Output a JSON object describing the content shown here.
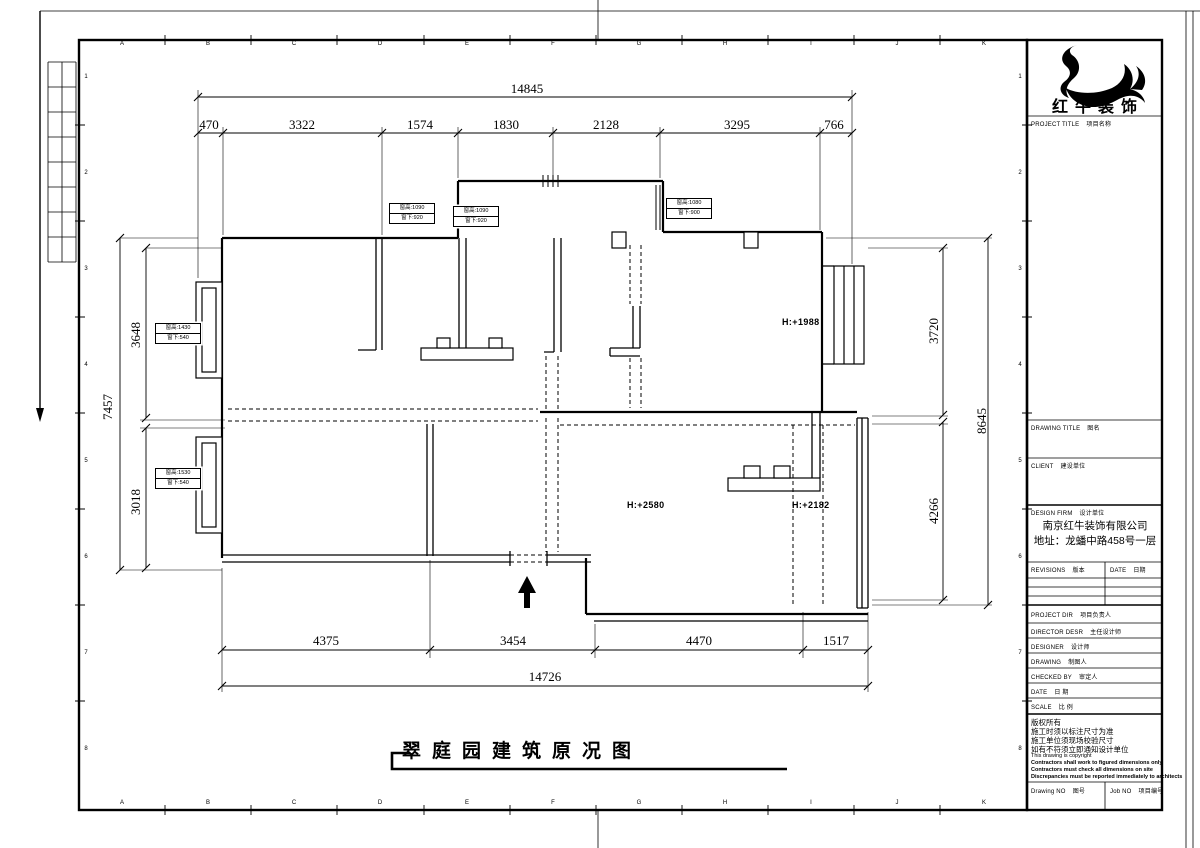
{
  "sheet": {
    "title": "翠庭园建筑原况图",
    "grid_letters": [
      "A",
      "B",
      "C",
      "D",
      "E",
      "F",
      "G",
      "H",
      "I",
      "J",
      "K"
    ],
    "grid_numbers": [
      "1",
      "2",
      "3",
      "4",
      "5",
      "6",
      "7",
      "8"
    ]
  },
  "dims": {
    "top_total": "14845",
    "top_segments": [
      "470",
      "3322",
      "1574",
      "1830",
      "2128",
      "3295",
      "766"
    ],
    "bottom_segments": [
      "4375",
      "3454",
      "4470",
      "1517"
    ],
    "bottom_total": "14726",
    "left_total": "7457",
    "left_upper": "3648",
    "left_lower": "3018",
    "right_upper": "3720",
    "right_lower": "4266",
    "right_total": "8645"
  },
  "plan_labels": {
    "room_right_height": "H:+1988",
    "living_height": "H:+2580",
    "balcony_height": "H:+2182",
    "window_tags": [
      {
        "l1": "窗高:1090",
        "l2": "窗下:920"
      },
      {
        "l1": "窗高:1090",
        "l2": "窗下:920"
      },
      {
        "l1": "窗高:1080",
        "l2": "窗下:900"
      },
      {
        "l1": "窗高:1430",
        "l2": "窗下:540"
      },
      {
        "l1": "窗高:1530",
        "l2": "窗下:540"
      }
    ]
  },
  "titleblock": {
    "brand": "红牛装饰",
    "project_title_en": "PROJECT TITLE",
    "project_title_cn": "项目名称",
    "drawing_title_en": "DRAWING TITLE",
    "drawing_title_cn": "图名",
    "client_en": "CLIENT",
    "client_cn": "建设单位",
    "design_firm_en": "DESIGN FIRM",
    "design_firm_cn": "设计单位",
    "company_name": "南京红牛装饰有限公司",
    "company_address": "地址：龙蟠中路458号一层",
    "revisions_en": "REVISIONS",
    "revisions_cn": "版本",
    "date_col_en": "DATE",
    "date_col_cn": "日期",
    "project_dir_en": "PROJECT DIR",
    "project_dir_cn": "项目负责人",
    "director_en": "DIRECTOR DESR",
    "director_cn": "主任设计师",
    "designer_en": "DESIGNER",
    "designer_cn": "设计师",
    "drawing_by_en": "DRAWING",
    "drawing_by_cn": "制图人",
    "checked_by_en": "CHECKED BY",
    "checked_by_cn": "审定人",
    "date_row_en": "DATE",
    "date_row_cn": "日 期",
    "scale_row_en": "SCALE",
    "scale_row_cn": "比 例",
    "copyright_cn": [
      "版权所有",
      "施工时须以标注尺寸为准",
      "施工单位须现场校验尺寸",
      "如有不符须立即通知设计单位"
    ],
    "copyright_en": "This drawing is copyright",
    "copyright_en_bold": [
      "Contractors shall work to figured dimensions only",
      "Contractors must check all dimensions on site",
      "Discrepancies must be reported immediately to architects"
    ],
    "drawing_no_en": "Drawing NO",
    "drawing_no_cn": "图号",
    "job_no_en": "Job NO",
    "job_no_cn": "项目编号"
  }
}
